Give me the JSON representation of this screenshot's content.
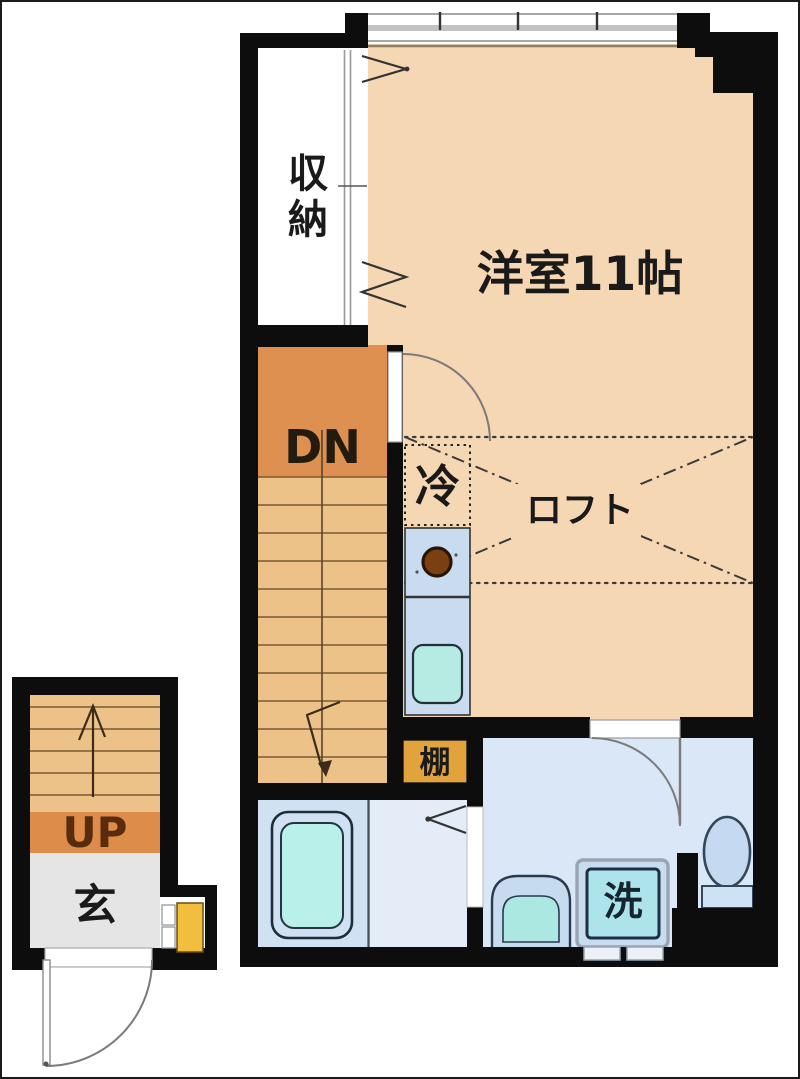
{
  "floorplan": {
    "title": "apartment floor plan (Japanese madori)",
    "labels": {
      "storage": "収納",
      "western_room": "洋室11帖",
      "stairs_down": "DN",
      "refrigerator": "冷",
      "loft": "ロフト",
      "shelf": "棚",
      "stairs_up": "UP",
      "entrance": "玄",
      "washing_machine": "洗"
    },
    "colors": {
      "wall": "#0d0d0d",
      "room_floor": "#f6d7b4",
      "stair_landing": "#de9050",
      "stair_steps": "#ecc289",
      "shelf_box": "#e2a33c",
      "shoe_cabinet": "#f2be3e",
      "kitchen_counter": "#c9dcef",
      "kitchen_sink": "#b5ebe3",
      "burner": "#7a4012",
      "bathroom_floor": "#cfe1f3",
      "bathtub": "#b9f0ea",
      "washroom_floor": "#e4ecf8",
      "hallway_floor": "#d9e7f6",
      "washer_drum": "#ade4eb",
      "entrance_floor": "#e5e5e5",
      "door_arc": "#7a7a7a",
      "dash_lines": "#3a3a3a",
      "up_text": "#5a2c0e",
      "dn_text": "#231a10"
    }
  }
}
